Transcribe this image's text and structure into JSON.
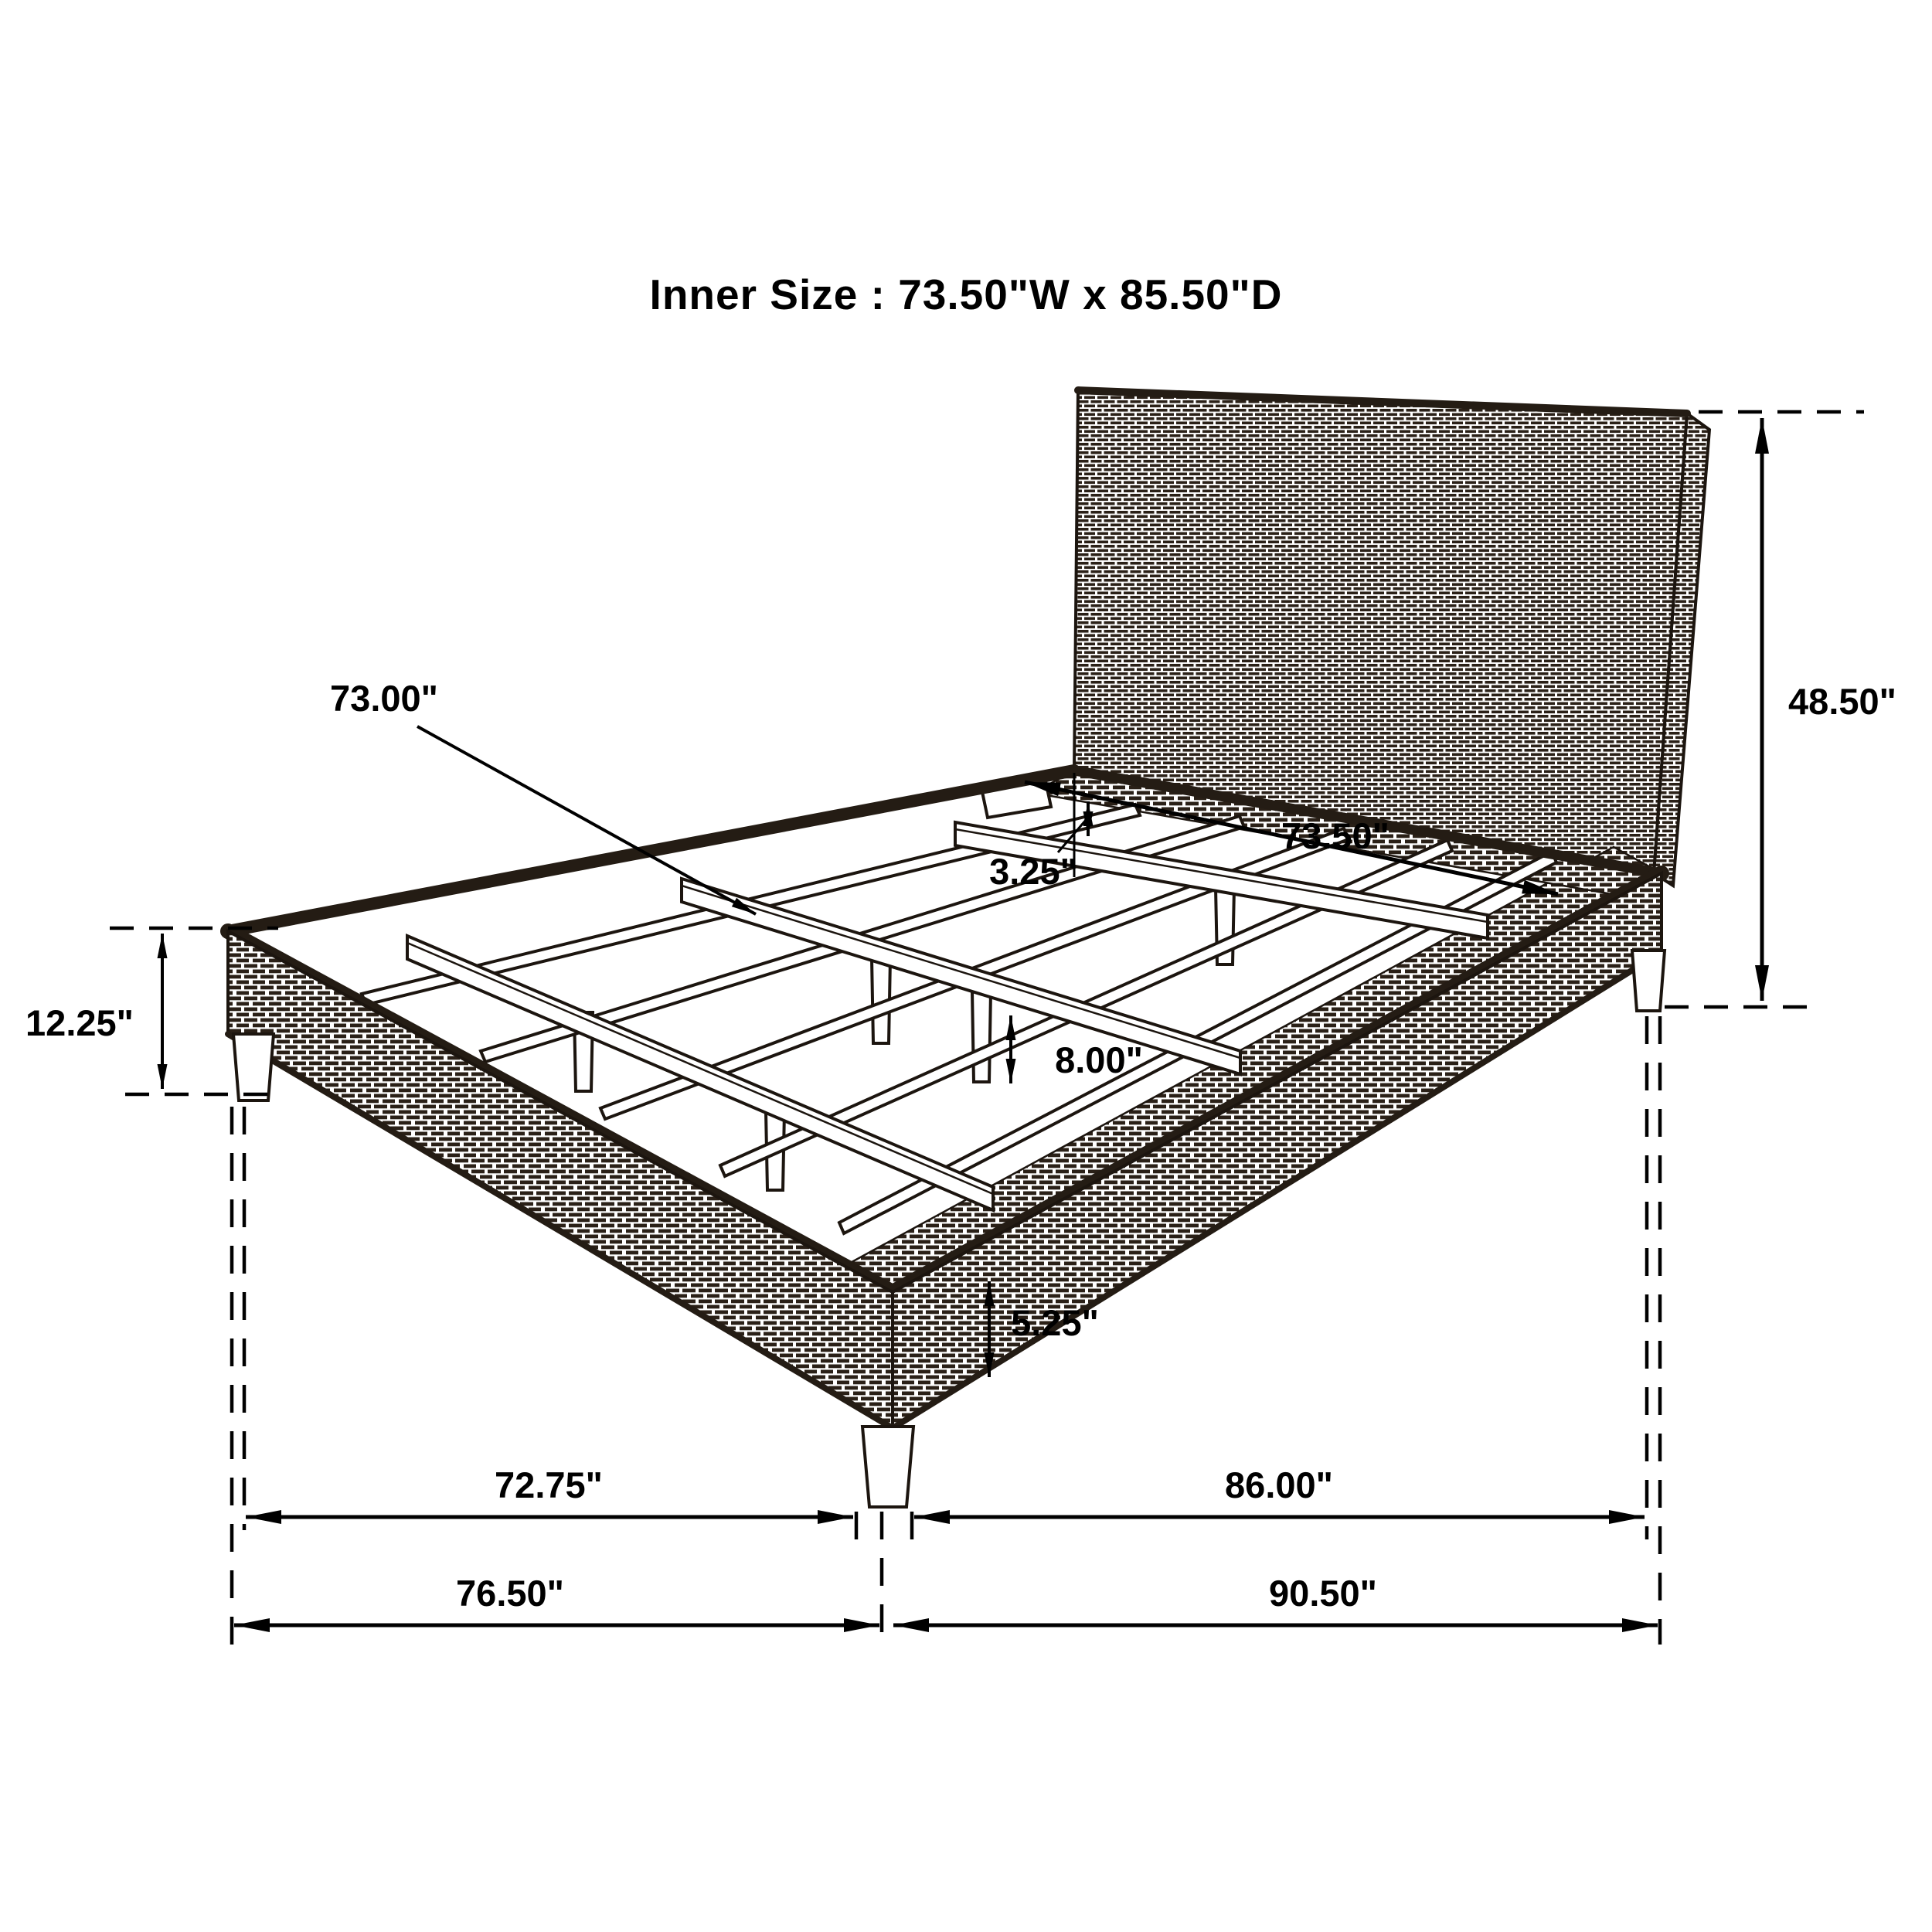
{
  "title": "Inner Size :  73.50\"W x 85.50\"D",
  "colors": {
    "ink": "#1c150f",
    "weave": "#2a2017",
    "piping": "#241c14",
    "background": "#ffffff"
  },
  "labels": {
    "slat_rail_length": "73.00\"",
    "headboard_height": "48.50\"",
    "footboard_height": "12.25\"",
    "rail_top_to_slat": "3.25\"",
    "inner_width": "73.50\"",
    "slat_support_height": "8.00\"",
    "leg_height": "5.25\"",
    "width_between_legs": "72.75\"",
    "depth_between_legs": "86.00\"",
    "overall_width": "76.50\"",
    "overall_depth": "90.50\""
  }
}
